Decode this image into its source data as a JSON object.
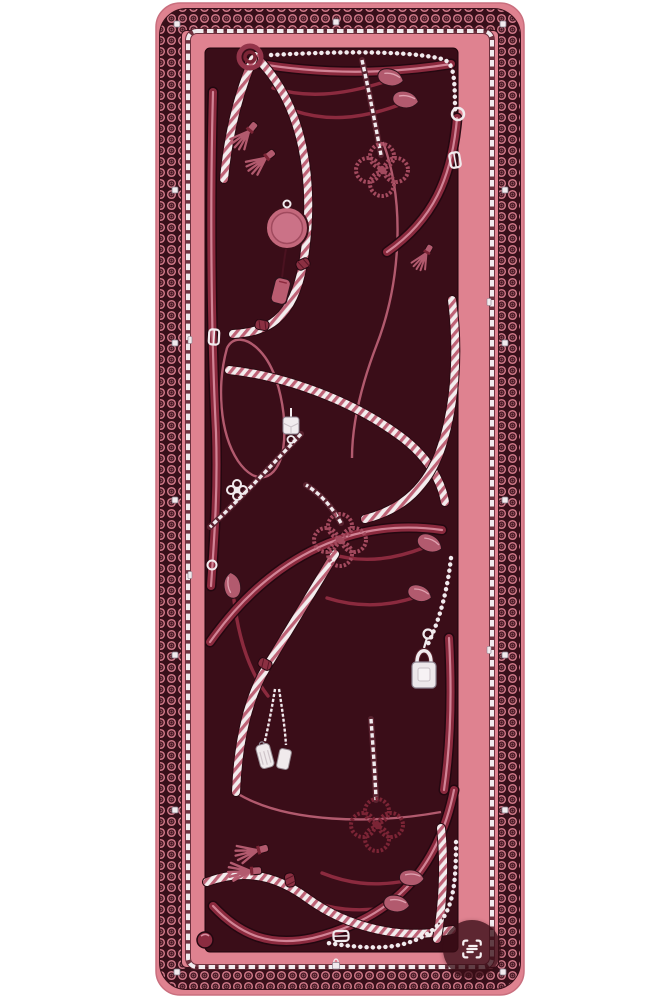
{
  "page": {
    "background_label": "white backdrop"
  },
  "colors": {
    "page": "#FFFFFF",
    "pink": "#DF8290",
    "pinkEdge": "#C96F7E",
    "dark": "#38101A",
    "field": "#3A0D18",
    "loopPink": "#CE7888",
    "silver": "#F1EBEE",
    "silverShade": "#8D8390",
    "chainDark": "#5A2330",
    "strap": "#8B2A3E",
    "strapEdge": "#230710",
    "strapHi": "#D88EA0",
    "rope": "#B25A6E",
    "ropeDark": "#7B2435",
    "braidWhite": "#F3EDEE",
    "braidPink": "#BE6276",
    "cloverMid": "#A34A5E",
    "lensBg": "rgba(56,13,22,0.78)",
    "lensIcon": "#F6F1F3"
  },
  "scarf": {
    "alt": "Rectangular burgundy and rose-pink silk scarf with equestrian motifs: braided chevron ropes, glossy leather straps with buckles and pointed tips, silver curb and bead chains, tassels, clover rope knots, a padlock charm, luggage-tag charms and a disc medallion, framed by an ornate chain-link border with white studs",
    "motifs": [
      "chain-link loop border",
      "silver chain-link row",
      "white square studs",
      "braided chevron ropes",
      "leather straps and buckles",
      "silver curb chains",
      "bead chains",
      "tassels",
      "clover rope knots",
      "padlock charm",
      "tag charms",
      "disc medallion with paddle tag",
      "dice cube charm",
      "flower cross charm",
      "strap-tip buds"
    ]
  },
  "overlay": {
    "visual_search_label": "Visual search",
    "icon": "scan-text-icon"
  }
}
